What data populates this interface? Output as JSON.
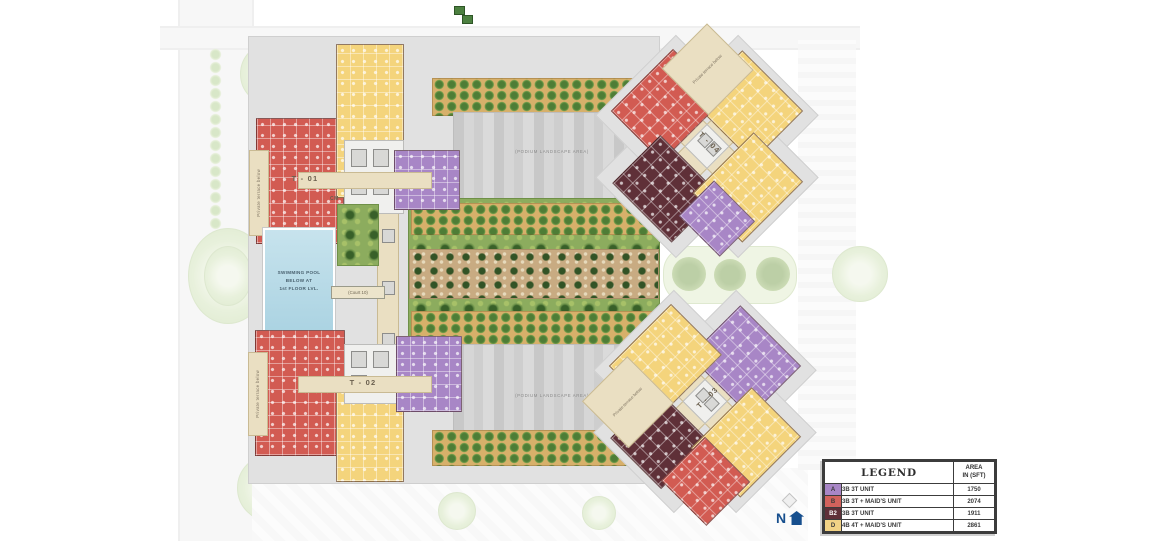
{
  "labels": {
    "t01": "T - 01",
    "t02": "T - 02",
    "t03": "T - 03",
    "t04": "T - 04",
    "cm": "CM",
    "court": "(Court 10)",
    "podium": "(PODIUM LANDSCAPE AREA)",
    "private_terrace": "Private terrace below",
    "pool_line1": "SWIMMING POOL",
    "pool_line2": "BELOW AT",
    "pool_line3": "1st FLOOR LVL."
  },
  "north": {
    "label": "N"
  },
  "legend": {
    "title": "LEGEND",
    "area_line1": "AREA",
    "area_line2": "IN (SFT)",
    "rows": [
      {
        "code": "A",
        "color": "#a886c6",
        "desc": "3B 3T UNIT",
        "area": "1750"
      },
      {
        "code": "B",
        "color": "#d2625c",
        "desc": "3B 3T + MAID'S UNIT",
        "area": "2074"
      },
      {
        "code": "B2",
        "color": "#5f3038",
        "desc": "3B 3T UNIT",
        "area": "1911"
      },
      {
        "code": "D",
        "color": "#f2d386",
        "desc": "4B 4T + MAID'S UNIT",
        "area": "2861"
      }
    ]
  },
  "colors": {
    "unit_a_purple": "#a886c6",
    "unit_b_red": "#d25b52",
    "unit_b2_maroon": "#5f3038",
    "unit_d_yellow": "#f4d47c",
    "corridor_beige": "#eadfc2",
    "pool_blue": "#b8dae7",
    "garden_green": "#8cac5e",
    "podium_gray": "#cecece",
    "north_blue": "#174f8e"
  }
}
